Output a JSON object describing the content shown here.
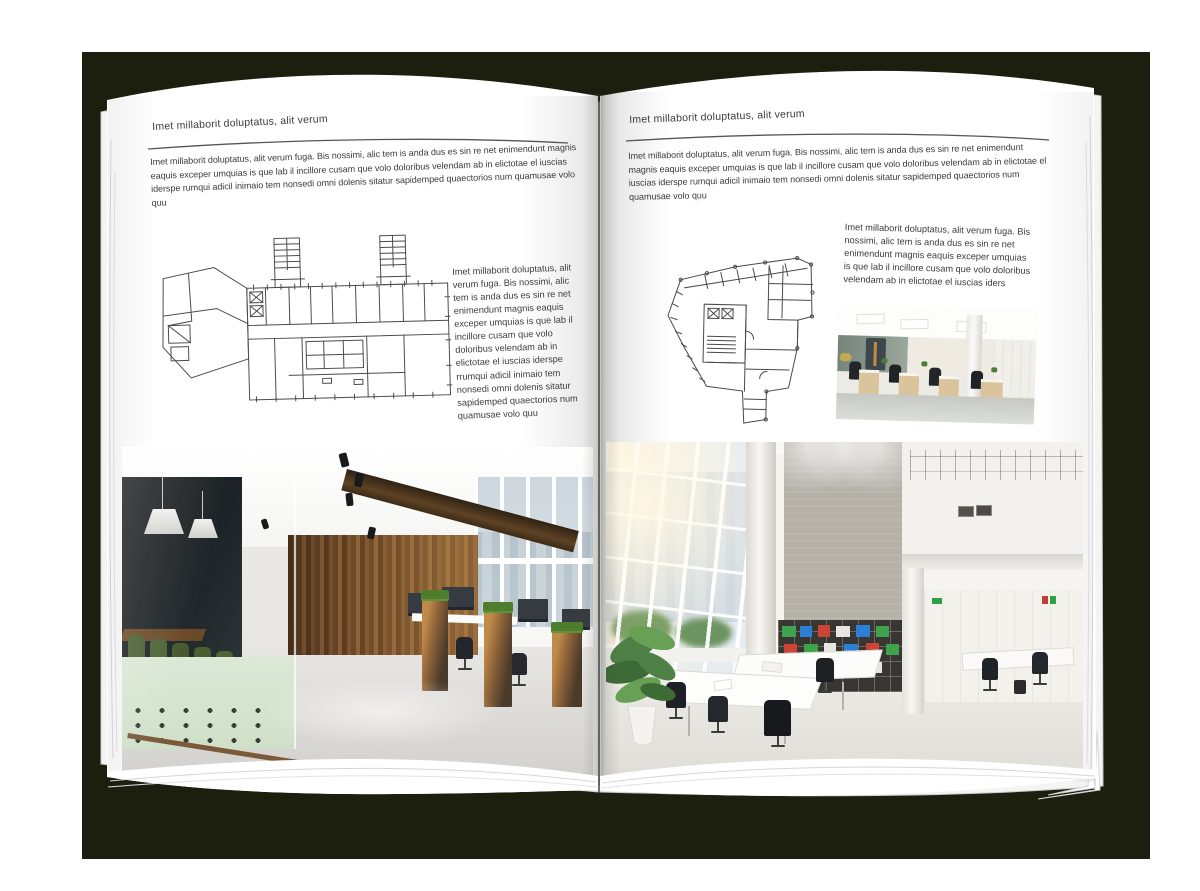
{
  "palette": {
    "backdrop": "#1c1e0e",
    "page": "#ffffff",
    "text": "#3b3b3b",
    "header_rule": "#555555",
    "floor_plan_line": "#4a4a4a",
    "wood": "#7a522c",
    "chair_green": "#4a5f31",
    "binder_green": "#3fa34d",
    "binder_blue": "#2b7fd4",
    "binder_red": "#cc4433"
  },
  "left_page": {
    "header": "Imet millaborit doluptatus, alit verum",
    "intro": "Imet millaborit doluptatus, alit verum fuga. Bis nossimi, alic tem is anda dus es sin re net enimendunt magnis eaquis exceper umquias is que lab il incillore cusam que volo doloribus velendam ab in elictotae el iuscias iderspe rumqui adicil inimaio tem nonsedi omni dolenis sitatur sapidemped quaectorios num quamusae volo quu",
    "caption": "Imet millaborit doluptatus, alit verum fuga. Bis nossimi, alic tem is anda dus es sin re net enimendunt magnis eaquis exceper umquias is que lab il incillore cusam que volo doloribus velendam ab in elictotae el iuscias iderspe rrumqui adicil inimaio tem nonsedi omni dolenis sitatur sapidemped quaectorios num quamusae volo quu",
    "floor_plan_alt": "architectural floor plan, wide slab building with two stair cores",
    "photo_alt": "open office with glass meeting room, dark wood wall and desk planters"
  },
  "right_page": {
    "header": "Imet millaborit doluptatus, alit verum",
    "intro": "Imet millaborit doluptatus, alit verum fuga. Bis nossimi, alic tem is anda dus es sin re net enimendunt magnis eaquis exceper umquias is que lab il incillore cusam que volo doloribus velendam ab in elictotae el iuscias iderspe rumqui adicil inimaio tem nonsedi omni dolenis sitatur sapidemped quaectorios num quamusae volo quu",
    "caption": "Imet millaborit doluptatus, alit verum fuga. Bis nossimi, alic tem is anda dus es sin re net enimendunt magnis eaquis exceper umquias is que lab il incillore cusam que volo doloribus velendam ab in elictotae el iuscias iders",
    "floor_plan_alt": "architectural floor plan, irregular tower footprint",
    "photo_small_alt": "bright open-plan office with desk rows",
    "photo_alt": "double-height white office atrium with bookshelf wall"
  }
}
